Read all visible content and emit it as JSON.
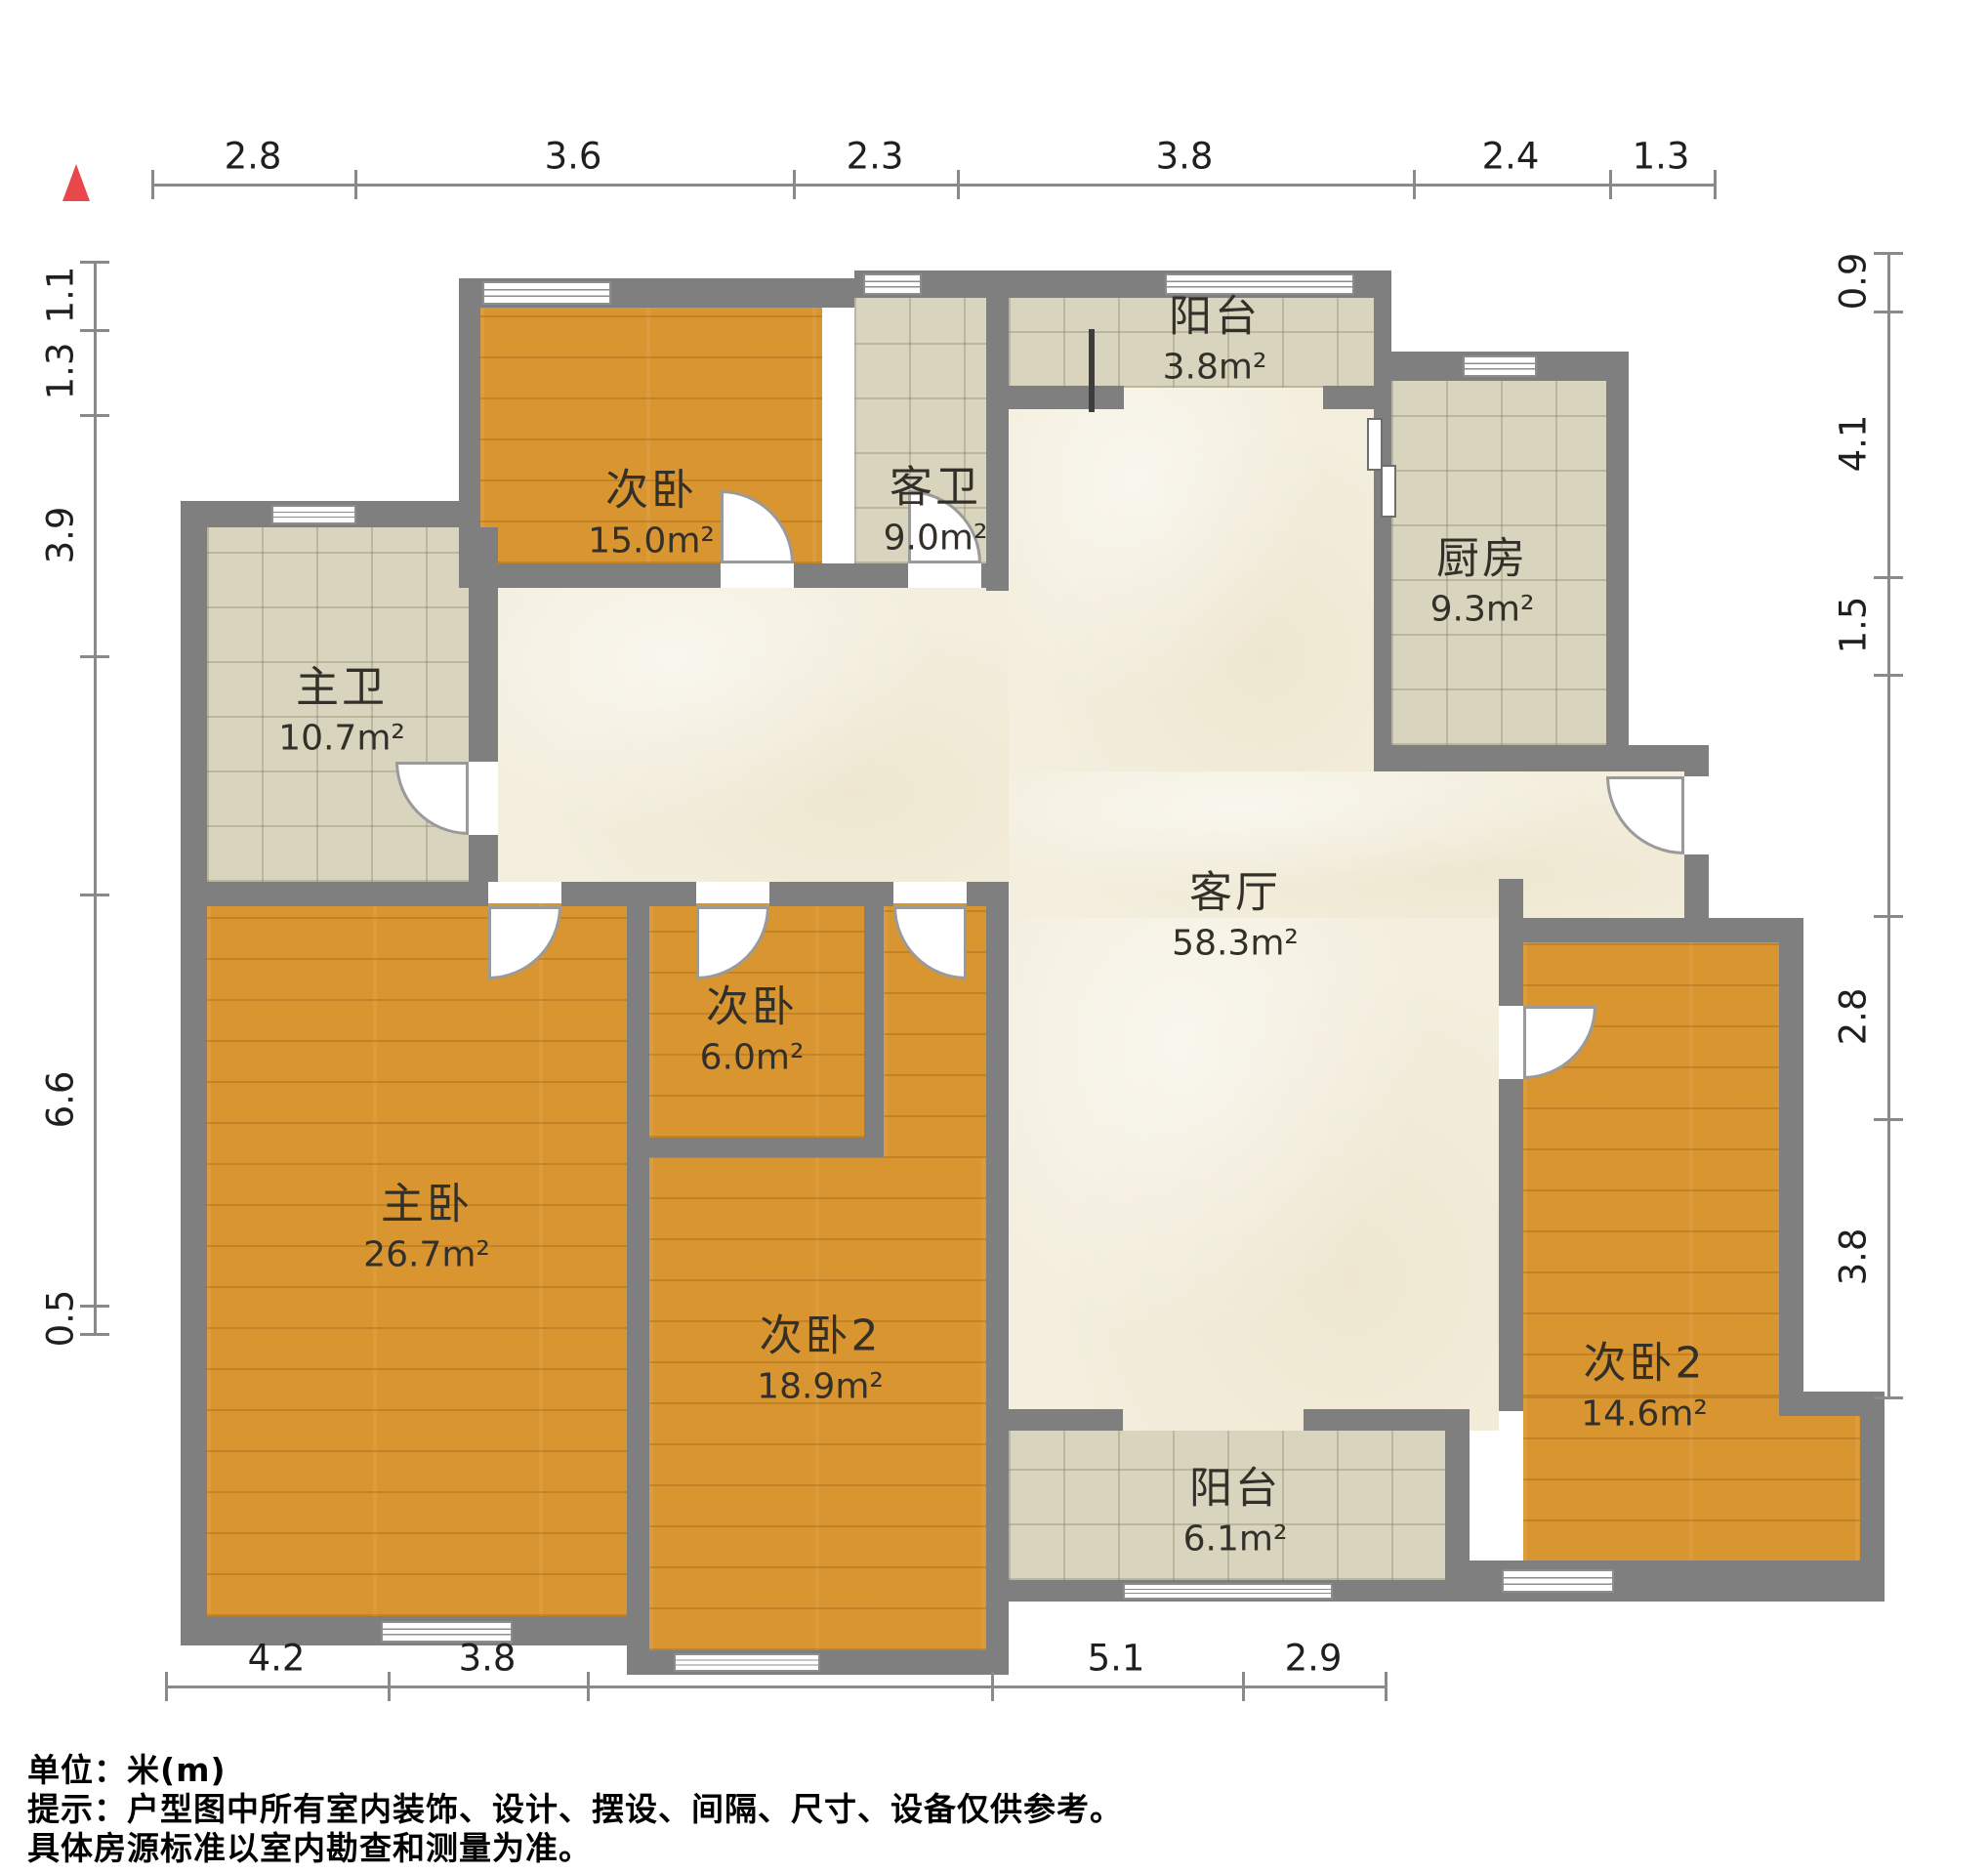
{
  "title": "户型图",
  "north_indicator": "north-arrow",
  "colors": {
    "wall": "#7f7f7f",
    "wood_floor": "#d9952f",
    "tile_floor": "#d8d4be",
    "marble_floor": "#f3eedd",
    "north_red": "#e8474b",
    "dim_line": "#8a8a8a"
  },
  "rooms": [
    {
      "id": "bedroom-top-left",
      "name": "次卧",
      "area": "15.0m²"
    },
    {
      "id": "guest-bathroom",
      "name": "客卫",
      "area": "9.0m²"
    },
    {
      "id": "balcony-top",
      "name": "阳台",
      "area": "3.8m²"
    },
    {
      "id": "kitchen",
      "name": "厨房",
      "area": "9.3m²"
    },
    {
      "id": "master-bathroom",
      "name": "主卫",
      "area": "10.7m²"
    },
    {
      "id": "living-room",
      "name": "客厅",
      "area": "58.3m²"
    },
    {
      "id": "master-bedroom",
      "name": "主卧",
      "area": "26.7m²"
    },
    {
      "id": "bedroom-small",
      "name": "次卧",
      "area": "6.0m²"
    },
    {
      "id": "bedroom2-middle",
      "name": "次卧2",
      "area": "18.9m²"
    },
    {
      "id": "bedroom2-right",
      "name": "次卧2",
      "area": "14.6m²"
    },
    {
      "id": "balcony-bottom",
      "name": "阳台",
      "area": "6.1m²"
    }
  ],
  "dimensions": {
    "top": [
      "2.8",
      "3.6",
      "2.3",
      "3.8",
      "2.4",
      "1.3"
    ],
    "left": [
      "1.1",
      "1.3",
      "3.9",
      "6.6",
      "0.5"
    ],
    "right": [
      "0.9",
      "4.1",
      "1.5",
      "2.8",
      "3.8"
    ],
    "bottom": [
      "4.2",
      "3.8",
      "5.1",
      "2.9"
    ]
  },
  "footer": {
    "unit_line": "单位：米(m)",
    "tip_line1": "提示：户型图中所有室内装饰、设计、摆设、间隔、尺寸、设备仅供参考。",
    "tip_line2": "具体房源标准以室内勘查和测量为准。"
  }
}
